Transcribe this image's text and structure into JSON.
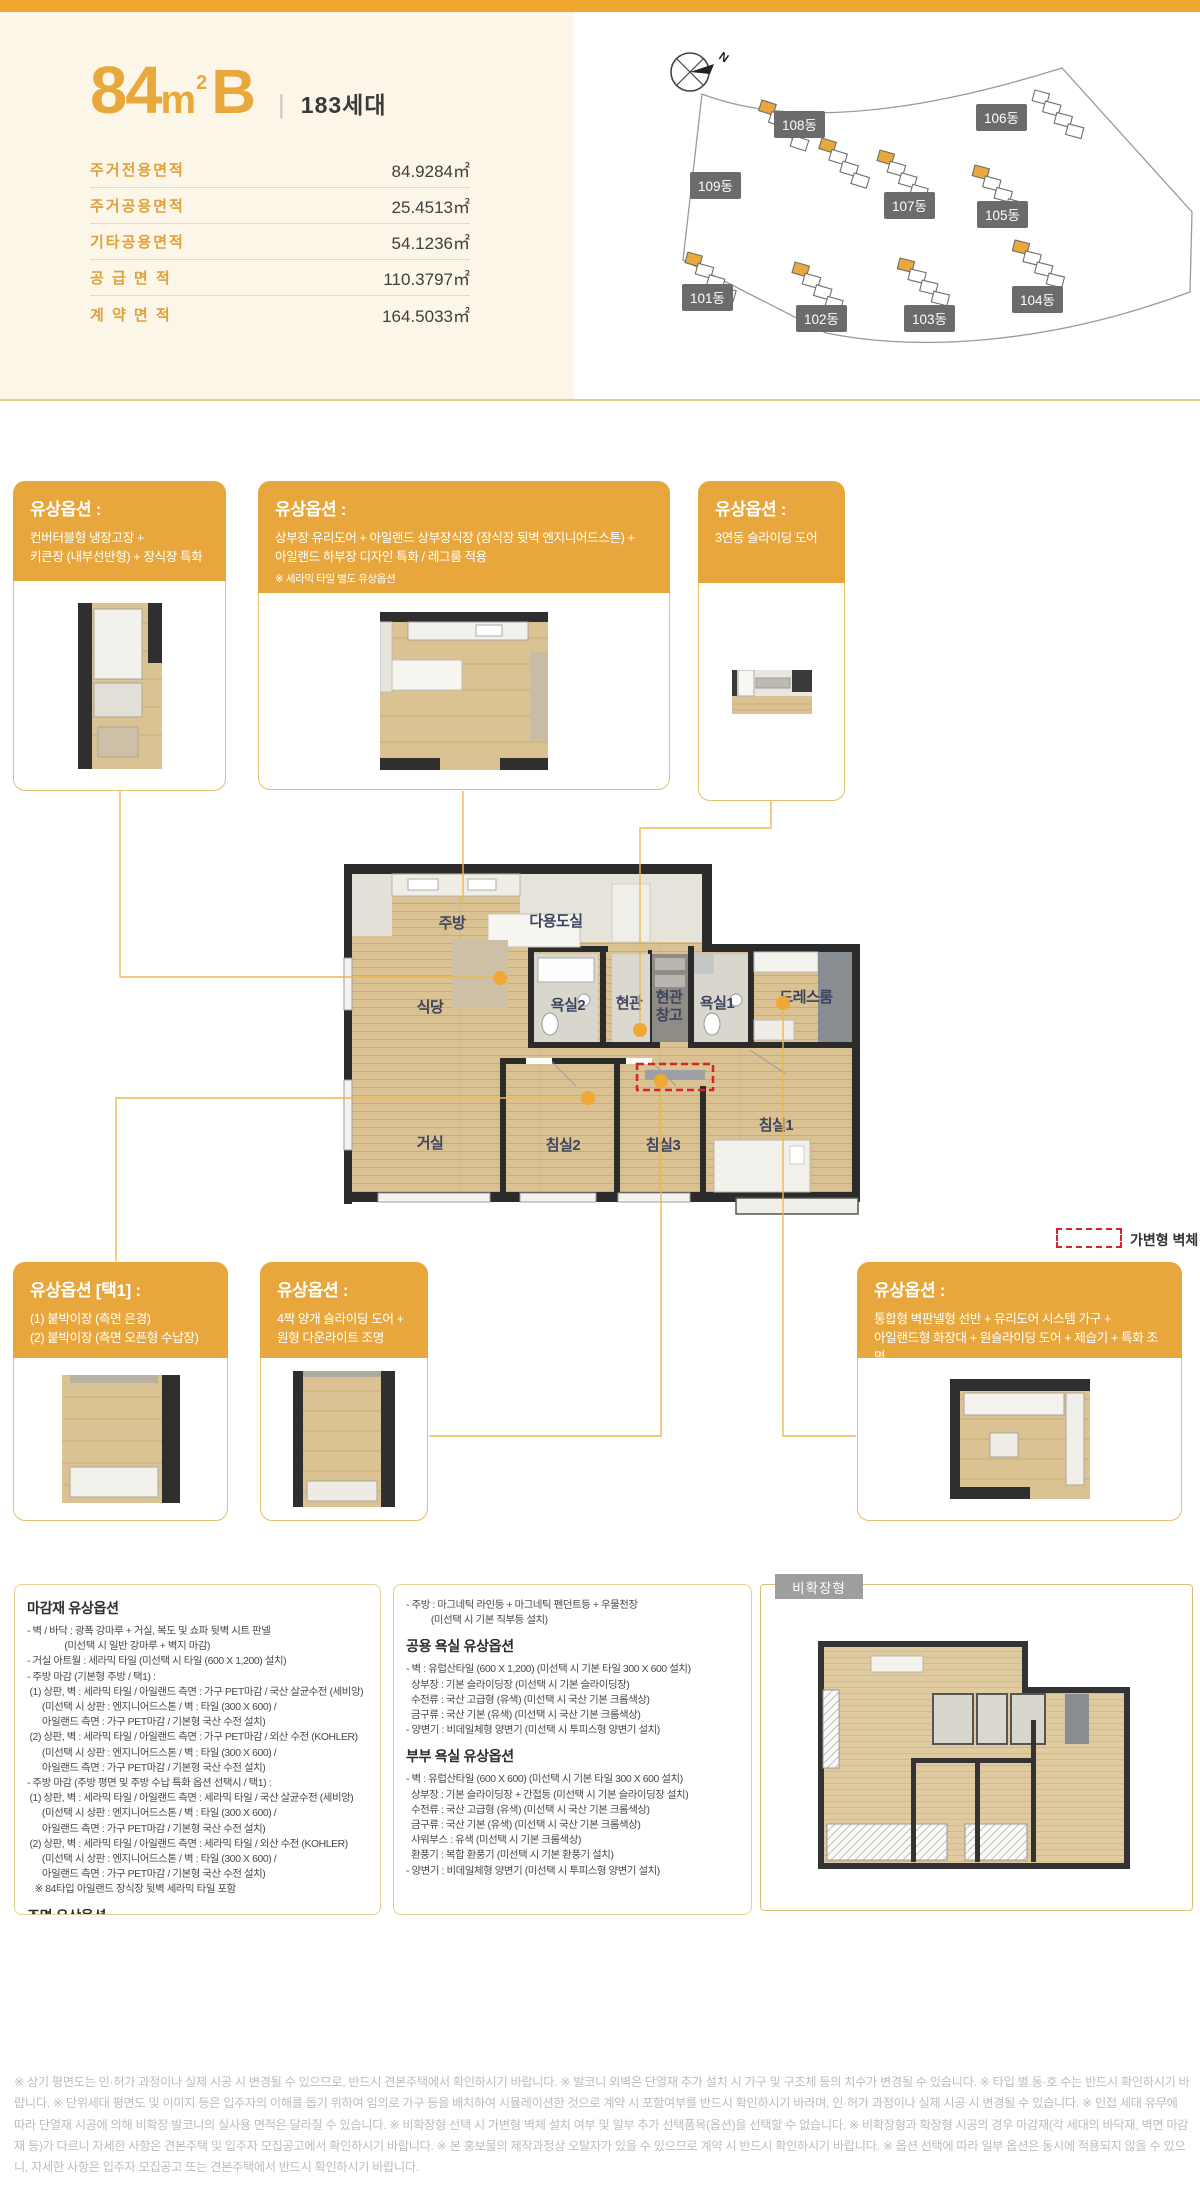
{
  "header": {
    "size_num": "84",
    "size_unit": "m",
    "size_exp": "2",
    "size_variant": "B",
    "divider": "|",
    "households": "183세대"
  },
  "area_table": {
    "rows": [
      {
        "label": "주거전용면적",
        "value": "84.9284㎡"
      },
      {
        "label": "주거공용면적",
        "value": "25.4513㎡"
      },
      {
        "label": "기타공용면적",
        "value": "54.1236㎡"
      },
      {
        "label": "공 급 면 적",
        "value": "110.3797㎡"
      },
      {
        "label": "계 약 면 적",
        "value": "164.5033㎡"
      }
    ]
  },
  "site_plan": {
    "compass": "N",
    "buildings": [
      {
        "label": "101동"
      },
      {
        "label": "102동"
      },
      {
        "label": "103동"
      },
      {
        "label": "104동"
      },
      {
        "label": "105동"
      },
      {
        "label": "106동"
      },
      {
        "label": "107동"
      },
      {
        "label": "108동"
      },
      {
        "label": "109동"
      }
    ]
  },
  "cards": [
    {
      "header": "유상옵션 :",
      "lines": [
        "컨버터블형 냉장고장 +",
        "키큰장 (내부선반형) + 장식장 특화"
      ]
    },
    {
      "header": "유상옵션 :",
      "lines": [
        "상부장 유리도어 + 아일랜드 상부장식장 (장식장 뒷벽 엔지니어드스톤) +",
        "아일랜드 하부장 디자인 특화 / 레그룸 적용"
      ],
      "note": "※ 세라믹 타일 별도 유상옵션"
    },
    {
      "header": "유상옵션 :",
      "lines": [
        "3연동 슬라이딩 도어"
      ]
    },
    {
      "header": "유상옵션 [택1] :",
      "lines": [
        "(1) 붙박이장 (측면 은경)",
        "(2) 붙박이장 (측면 오픈형 수납장)"
      ]
    },
    {
      "header": "유상옵션 :",
      "lines": [
        "4짝 양개 슬라이딩 도어 +",
        "원형 다운라이트 조명"
      ]
    },
    {
      "header": "유상옵션 :",
      "lines": [
        "통합형 벽판넬형 선반 + 유리도어 시스템 가구 +",
        "아일랜드형 화장대 + 원슬라이딩 도어 + 제습기 + 특화 조명"
      ]
    }
  ],
  "floorplan": {
    "rooms": {
      "kitchen": "주방",
      "utility": "다용도실",
      "dining": "식당",
      "bath2": "욕실2",
      "entry": "현관",
      "entry_storage_1": "현관",
      "entry_storage_2": "창고",
      "bath1": "욕실1",
      "dressroom": "드레스룸",
      "living": "거실",
      "bed2": "침실2",
      "bed3": "침실3",
      "bed1": "침실1"
    }
  },
  "legend": {
    "movable_wall": "가변형 벽체"
  },
  "specs": {
    "finish": {
      "heading": "마감재 유상옵션",
      "lines": [
        "- 벽 / 바닥 : 광폭 강마루 + 거실, 복도 및 쇼파 뒷벽 시트 판넬",
        "               (미선택 시 일반 강마루 + 벽지 마감)",
        "- 거실 아트월 : 세라믹 타일 (미선택 시 타일 (600 X 1,200) 설치)",
        "- 주방 마감 (기본형 주방 / 택1) :",
        " (1) 상판, 벽 : 세라믹 타일 / 아일랜드 측면 : 가구 PET마감 / 국산 살균수전 (세비앙)",
        "      (미선택 시 상판 : 엔지니어드스톤 / 벽 : 타일 (300 X 600) /",
        "      아일랜드 측면 : 가구 PET마감 / 기본형 국산 수전 설치)",
        " (2) 상판, 벽 : 세라믹 타일 / 아일랜드 측면 : 가구 PET마감 / 외산 수전 (KOHLER)",
        "      (미선택 시 상판 : 엔지니어드스톤 / 벽 : 타일 (300 X 600) /",
        "      아일랜드 측면 : 가구 PET마감 / 기본형 국산 수전 설치)",
        "- 주방 마감 (주방 평면 및 주방 수납 특화 옵션 선택시 / 택1) :",
        " (1) 상판, 벽 : 세라믹 타일 / 아일랜드 측면 : 세라믹 타일 / 국산 살균수전 (세비앙)",
        "      (미선택 시 상판 : 엔지니어드스톤 / 벽 : 타일 (300 X 600) /",
        "      아일랜드 측면 : 가구 PET마감 / 기본형 국산 수전 설치)",
        " (2) 상판, 벽 : 세라믹 타일 / 아일랜드 측면 : 세라믹 타일 / 외산 수전 (KOHLER)",
        "      (미선택 시 상판 : 엔지니어드스톤 / 벽 : 타일 (300 X 600) /",
        "      아일랜드 측면 : 가구 PET마감 / 기본형 국산 수전 설치)",
        "   ※ 84타입 아일랜드 장식장 뒷벽 세라믹 타일 포함"
      ]
    },
    "lighting": {
      "heading": "조명 유상옵션",
      "lines": [
        "- 거실 : 우물천장 4면 라인조명 + 마그네틱등 + 커튼박스 조명 + 실링팬",
        "          (미선택 시 기본 직부등, 커튼박스 조명 미적용, 실링팬 미설치)"
      ]
    },
    "lighting_cont": {
      "lines": [
        "- 주방 : 마그네틱 라인등 + 마그네틱 펜던트등 + 우물천장",
        "          (미선택 시 기본 직부등 설치)"
      ]
    },
    "common_bath": {
      "heading": "공용 욕실 유상옵션",
      "lines": [
        "- 벽 : 유럽산타일 (600 X 1,200) (미선택 시 기본 타일 300 X 600 설치)",
        "  상부장 : 기본 슬라이딩장 (미선택 시 기본 슬라이딩장)",
        "  수전류 : 국산 고급형 (유색) (미선택 시 국산 기본 크롬색상)",
        "  금구류 : 국산 기본 (유색) (미선택 시 국산 기본 크롬색상)",
        "- 양변기 : 비데일체형 양변기 (미선택 시 투피스형 양변기 설치)"
      ]
    },
    "master_bath": {
      "heading": "부부 욕실 유상옵션",
      "lines": [
        "- 벽 : 유럽산타일 (600 X 600) (미선택 시 기본 타일 300 X 600 설치)",
        "  상부장 : 기본 슬라이딩장 + 간접등 (미선택 시 기본 슬라이딩장 설치)",
        "  수전류 : 국산 고급형 (유색) (미선택 시 국산 기본 크롬색상)",
        "  금구류 : 국산 기본 (유색) (미선택 시 국산 기본 크롬색상)",
        "  샤워부스 : 유색 (미선택 시 기본 크롬색상)",
        "  환풍기 : 복합 환풍기 (미선택 시 기본 환풍기 설치)",
        "- 양변기 : 비데일체형 양변기 (미선택 시 투피스형 양변기 설치)"
      ]
    }
  },
  "unexpanded": {
    "label": "비확장형"
  },
  "footer": {
    "disclaimer": "※ 상기 평면도는 인·허가 과정이나 실제 시공 시 변경될 수 있으므로, 반드시 견본주택에서 확인하시기 바랍니다. ※ 발코니 외벽은 단열재 추가 설치 시 가구 및 구조체 등의 치수가 변경될 수 있습니다. ※ 타입 별 동·호 수는 반드시 확인하시기 바랍니다. ※ 단위세대 평면도 및 이미지 등은 입주자의 이해를 돕기 위하여 임의로 가구 등을 배치하여 시뮬레이션한 것으로 계약 시 포함여부를 반드시 확인하시기 바라며, 인·허가 과정이나 실제 시공 시 변경될 수 있습니다. ※ 인접 세대 유무에 따라 단열재 시공에 의해 비확장 발코니의 실사용 면적은 달라질 수 있습니다. ※ 비확장형 선택 시 가변형 벽체 설치 여부 및 일부 추가 선택품목(옵션)을 선택할 수 없습니다. ※ 비확장형과 확장형 시공의 경우 마감재(각 세대의 바닥재, 벽면 마감재 등)가 다르니 자세한 사항은 견본주택 및 입주자 모집공고에서 확인하시기 바랍니다. ※ 본 홍보물의 제작과정상 오탈자가 있을 수 있으므로 계약 시 반드시 확인하시기 바랍니다. ※ 옵션 선택에 따라 일부 옵션은 동시에 적용되지 않을 수 있으니, 자세한 사항은 입주자 모집공고 또는 견본주택에서 반드시 확인하시기 바랍니다."
  },
  "colors": {
    "accent_gold": "#E7A73C",
    "cream_bg": "#FBF6E8",
    "badge_gray": "#6B6B6B",
    "wall_dark": "#2B2B2B",
    "movable_wall_red": "#D7232B",
    "connector_gold": "#ECB94E",
    "wood_floor": "#DBC293"
  }
}
